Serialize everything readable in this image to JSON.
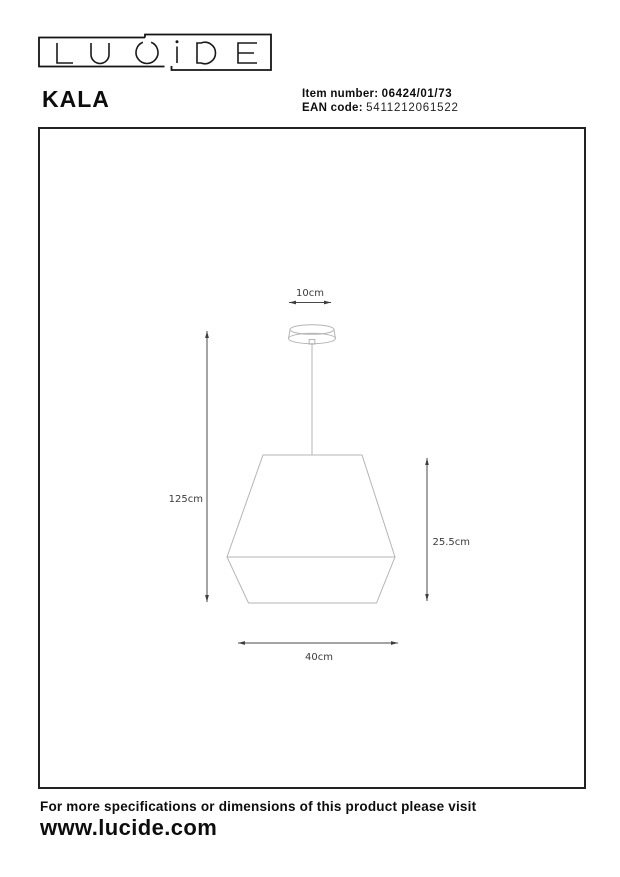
{
  "brand": {
    "name": "LUCIDE"
  },
  "product": {
    "name": "KALA"
  },
  "codes": {
    "item_label": "Item number:",
    "item_value": "06424/01/73",
    "ean_label": "EAN code:",
    "ean_value": "5411212061522"
  },
  "drawing": {
    "canopy_width_label": "10cm",
    "overall_height_label": "125cm",
    "shade_height_label": "25.5cm",
    "shade_diameter_label": "40cm"
  },
  "footer": {
    "note": "For more specifications or dimensions of this product please visit",
    "url": "www.lucide.com"
  }
}
